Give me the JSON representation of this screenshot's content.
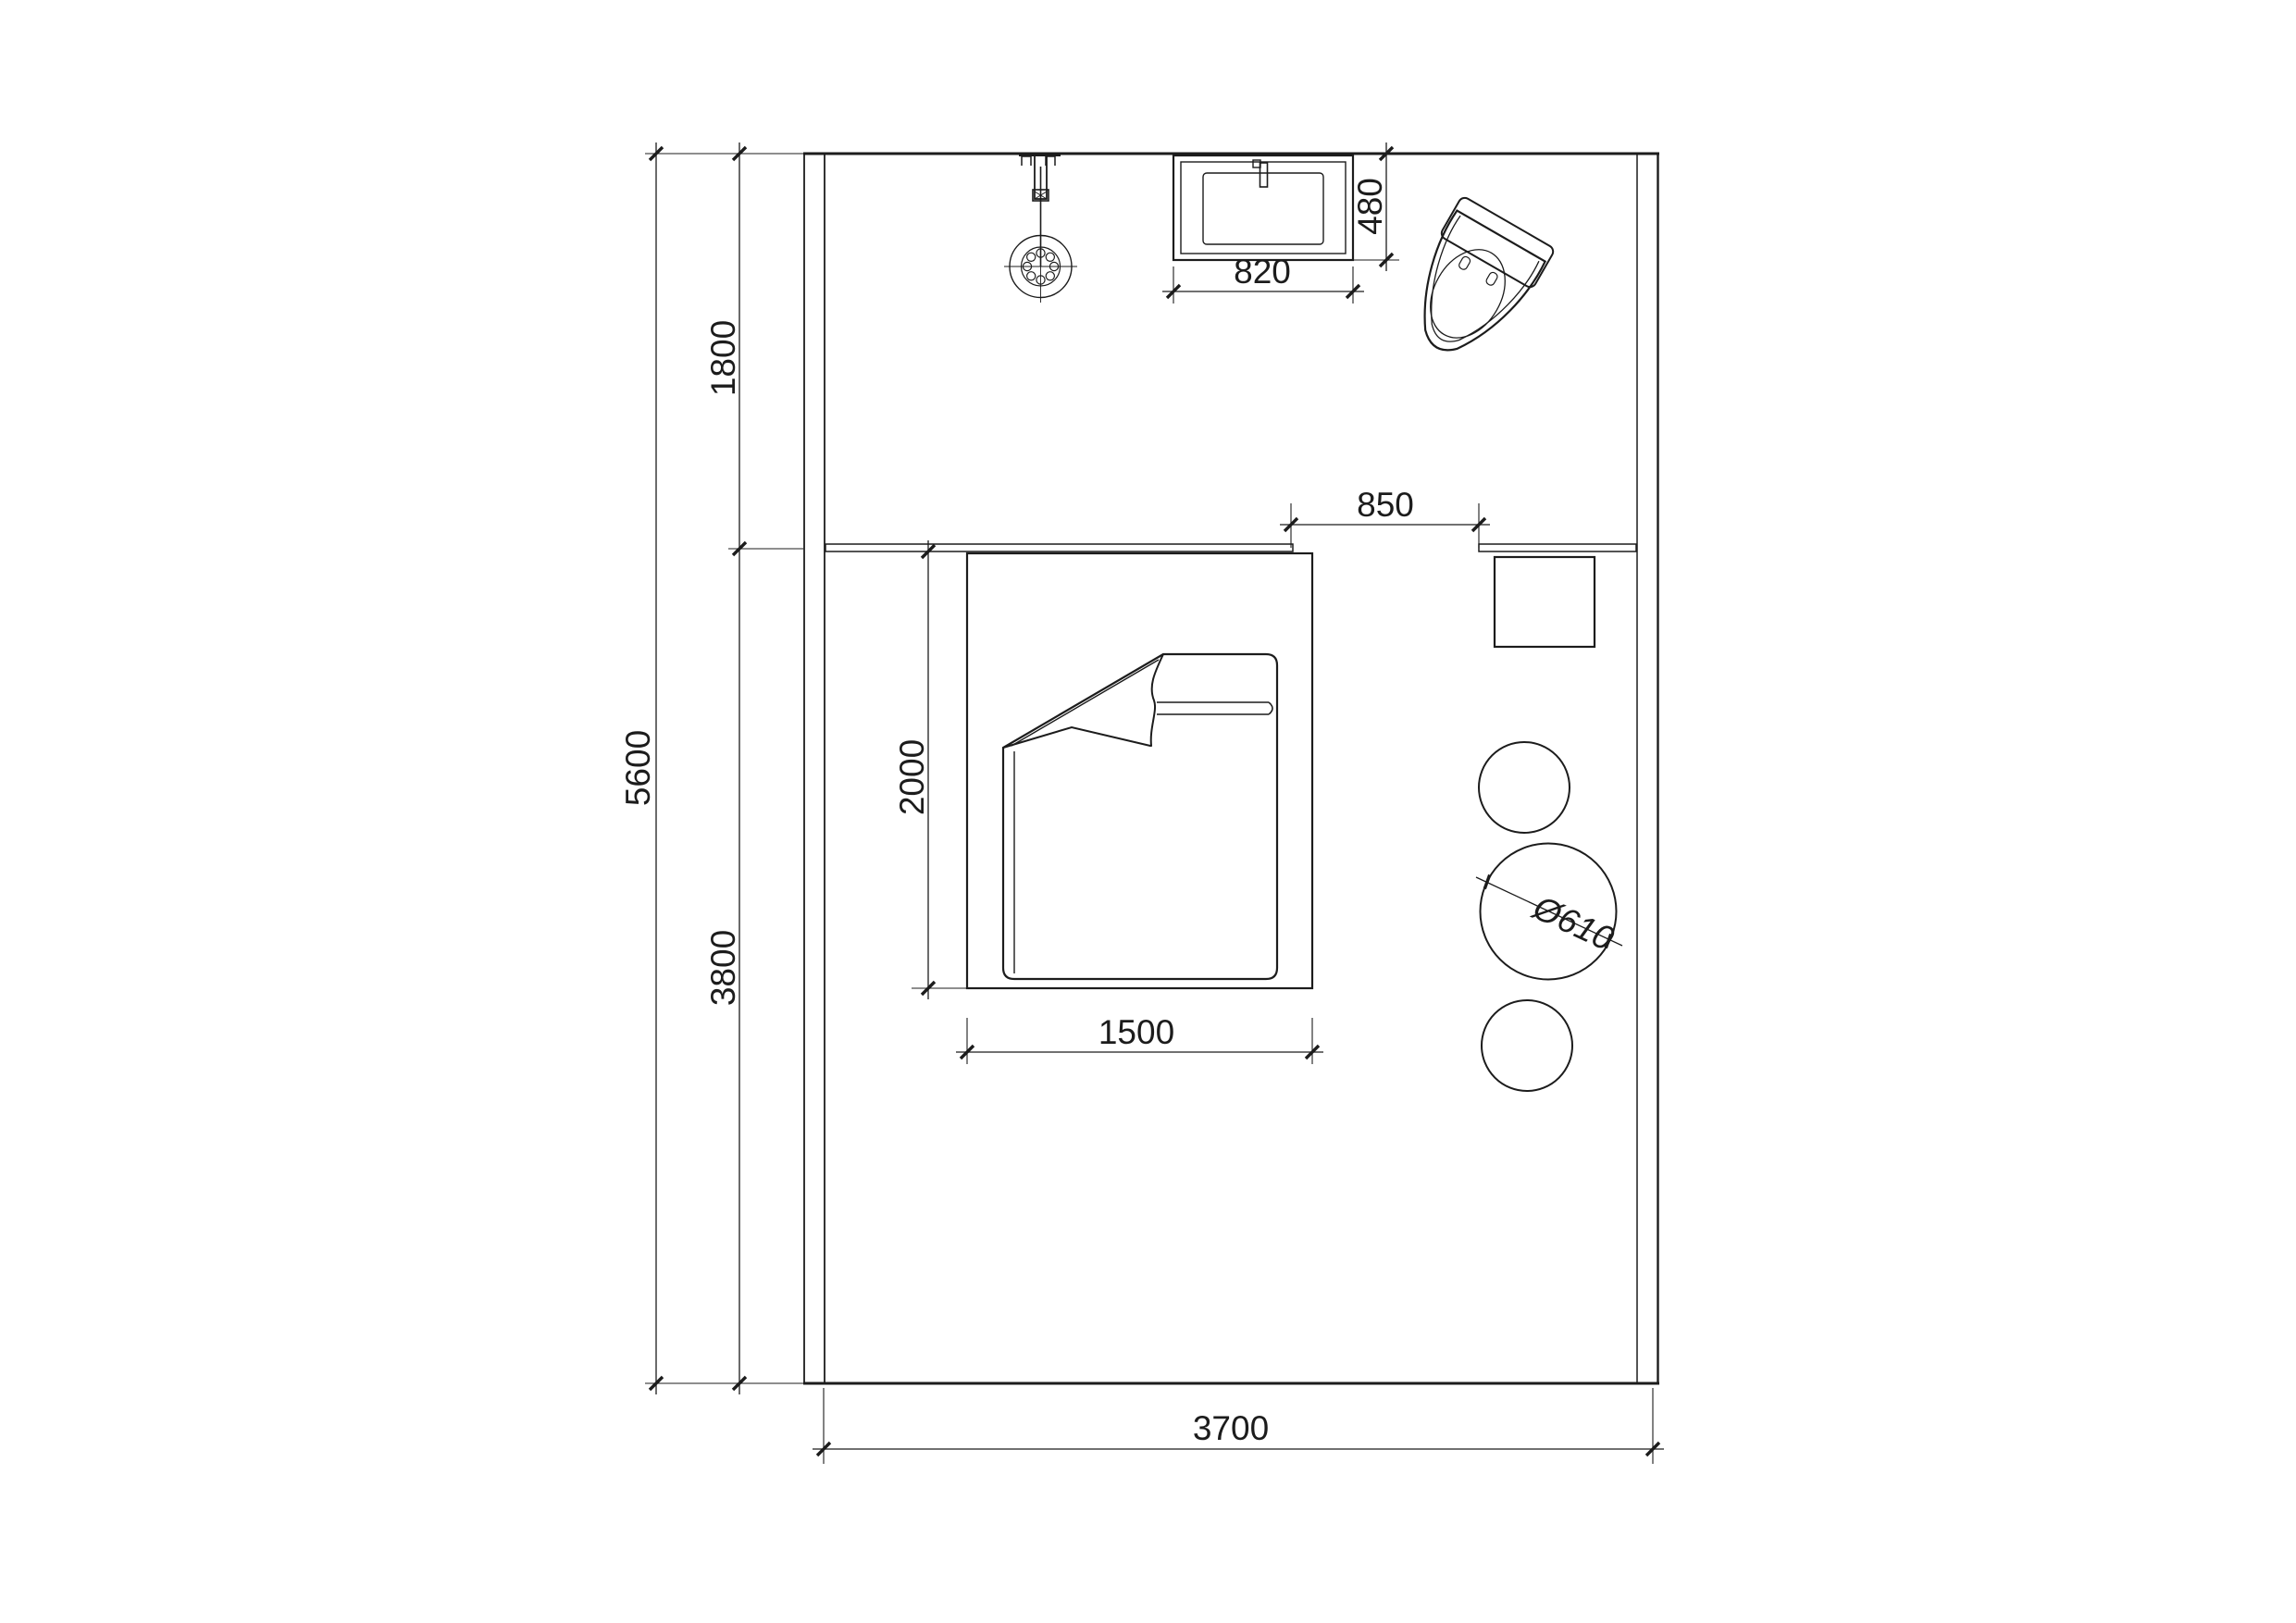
{
  "page": {
    "background": "#ffffff",
    "ink": "#1c1c1c"
  },
  "plan": {
    "type": "bedroom floor plan (top view)",
    "labels": {
      "total_height": "5600",
      "zone_top_height": "1800",
      "zone_bottom_height": "3800",
      "room_width": "3700",
      "bed_length": "2000",
      "bed_width": "1500",
      "basin_width": "820",
      "basin_depth": "480",
      "passage_gap": "850",
      "table_diameter": "Ø610"
    },
    "objects": [
      "exterior-walls",
      "headboard-ledge",
      "double-bed",
      "pillows",
      "folded-blanket",
      "pendant-light",
      "wash-basin",
      "toilet",
      "bedside-table",
      "stool-small-top",
      "round-table",
      "stool-small-bottom"
    ]
  }
}
